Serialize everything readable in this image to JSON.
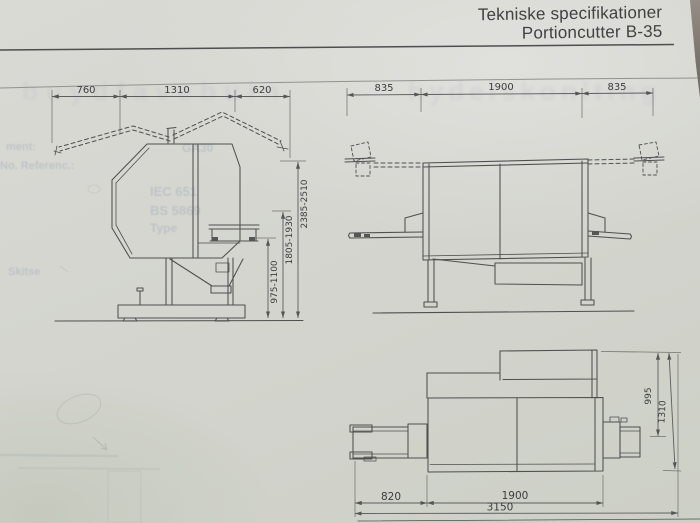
{
  "photo": {
    "paper_color": "#d5d6d0",
    "background_corner_color": "#79736c"
  },
  "header": {
    "line1": "Tekniske specifikationer",
    "line2": "Portioncutter B-35"
  },
  "views": {
    "side": {
      "dims_top": [
        "760",
        "1310",
        "620"
      ],
      "dims_height": [
        "975-1100",
        "1805-1930",
        "2385-2510"
      ]
    },
    "front": {
      "dims_top": [
        "835",
        "1900",
        "835"
      ]
    },
    "plan": {
      "dims_bottom": [
        "820",
        "1900"
      ],
      "dim_overall": "3150",
      "dims_side": [
        "995",
        "1310"
      ]
    }
  },
  "ghost_text": {
    "label1": "ment:",
    "label2": "No. Referenc.:",
    "label3": "GA30",
    "label4": "IEC 651",
    "label5": "BS 5869",
    "label6": "Type",
    "label7": "Skitse",
    "watermark_left": "buydfavebuln",
    "watermark_right": "hydelskonlting"
  }
}
